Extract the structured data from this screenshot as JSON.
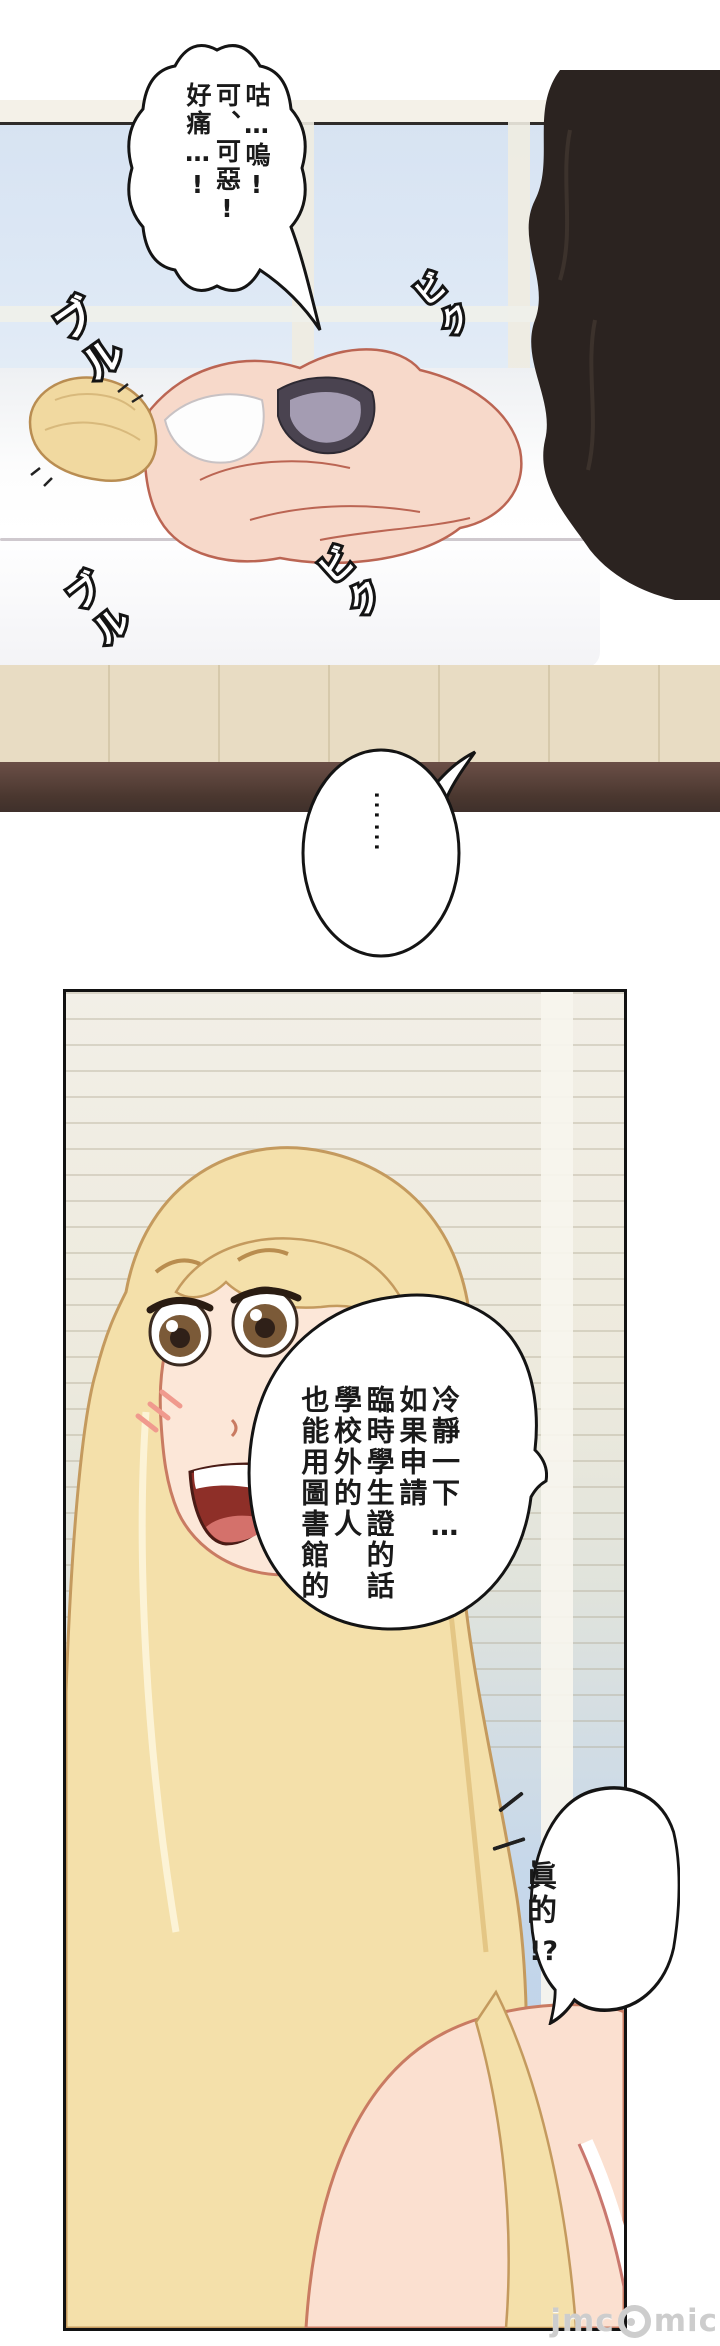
{
  "panel1": {
    "speech_bubble": {
      "columns": [
        "咕…嗚!",
        "可、可惡!",
        "好痛…!"
      ]
    },
    "ellipsis_bubble": {
      "text": "……"
    },
    "sfx": [
      {
        "text": "ブル"
      },
      {
        "text": "ビク"
      },
      {
        "text": "ビク"
      },
      {
        "text": "ブル"
      }
    ]
  },
  "panel2": {
    "speech_bubble": {
      "columns": [
        "冷靜一下…",
        "如果申請",
        "臨時學生證的話",
        "學校外的人",
        "也能用圖書館的"
      ]
    },
    "reply_bubble": {
      "line1": "眞的",
      "line2": "!?"
    }
  },
  "watermark": {
    "prefix": "jmc",
    "suffix": "mic",
    "logo": "panda-circle-logo"
  },
  "colors": {
    "sky_window": "#dce7f4",
    "blinds": "#f2efe6",
    "sky_panel2": "#b5cde8",
    "skin": "#f7d9ca",
    "skin_outline": "#bb6553",
    "hair_blonde": "#f2dda6",
    "hair_outline": "#c49a5e",
    "dark_figure": "#2b2320",
    "floor_wood": "#e8dcc3",
    "floor_dark_band": "#4a372f",
    "shorts_gray": "#a49cb2",
    "mouth_red": "#8e2f28",
    "line_art": "#1a1a1a"
  }
}
